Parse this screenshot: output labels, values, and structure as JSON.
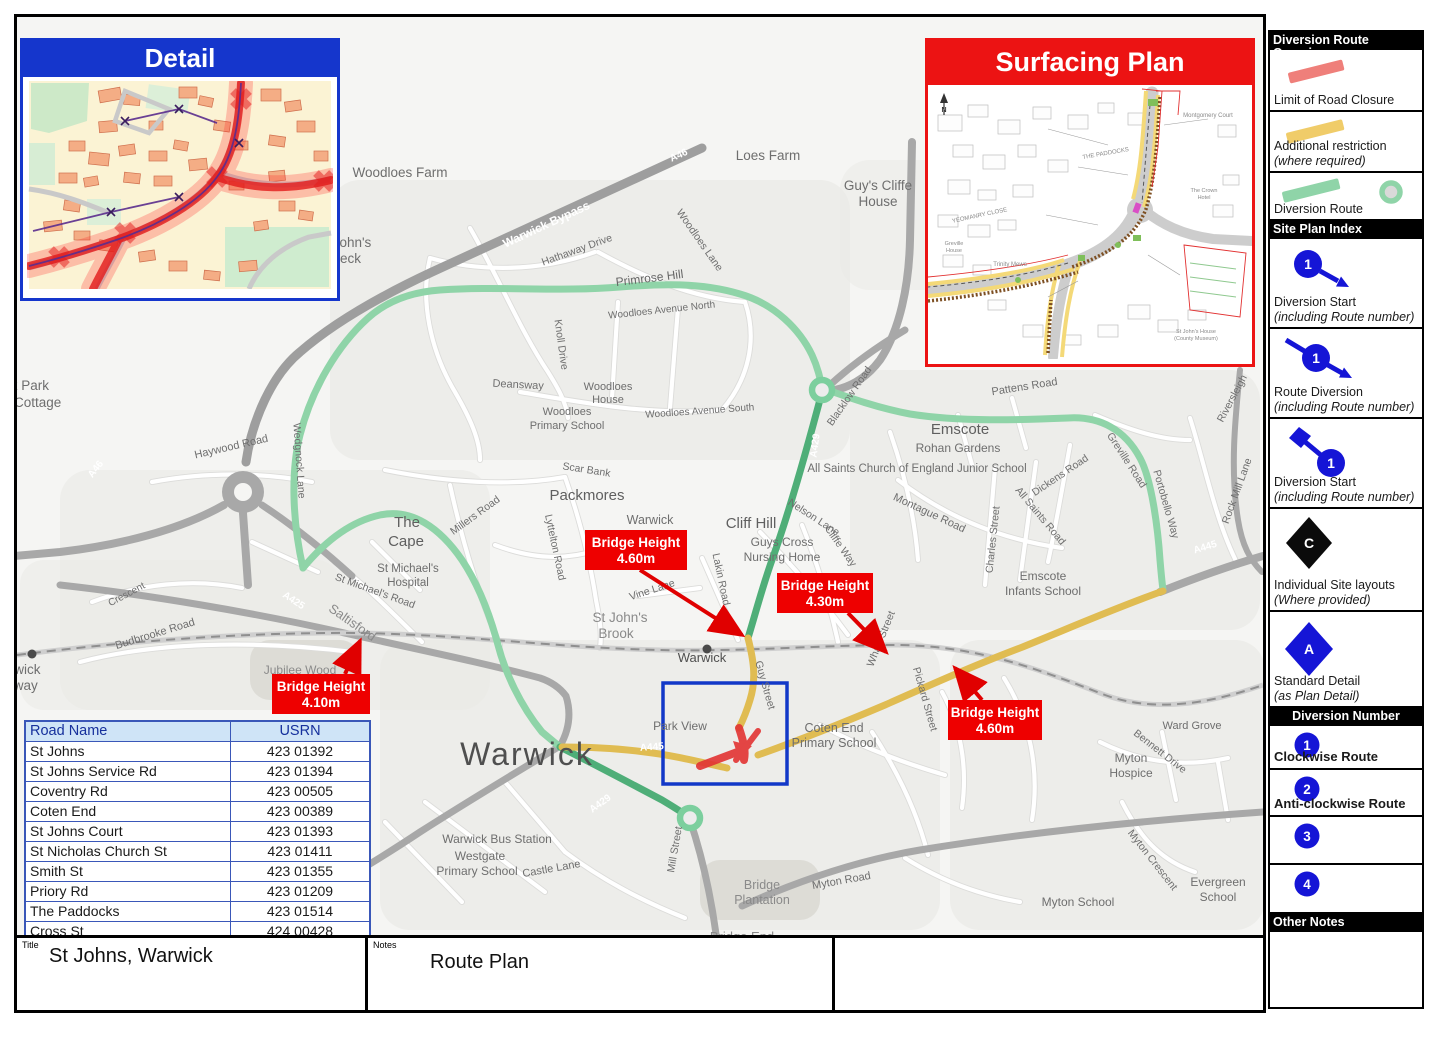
{
  "detail_inset": {
    "title": "Detail"
  },
  "surfacing_inset": {
    "title": "Surfacing Plan",
    "labels": [
      {
        "t": "N",
        "x": 16,
        "y": 27,
        "s": 7,
        "w": "b",
        "c": "#333333"
      },
      {
        "t": "Montgomery Court",
        "x": 280,
        "y": 32,
        "s": 6
      },
      {
        "t": "THE PADDOCKS",
        "x": 178,
        "y": 70,
        "s": 6,
        "r": -10
      },
      {
        "t": "YEOMANRY CLOSE",
        "x": 52,
        "y": 132,
        "s": 6,
        "r": -12
      },
      {
        "t": "Greville",
        "x": 26,
        "y": 160,
        "s": 5.5
      },
      {
        "t": "House",
        "x": 26,
        "y": 167,
        "s": 5.5
      },
      {
        "t": "Trinity Mews",
        "x": 82,
        "y": 181,
        "s": 6
      },
      {
        "t": "The Crown",
        "x": 276,
        "y": 107,
        "s": 5.5
      },
      {
        "t": "Hotel",
        "x": 276,
        "y": 114,
        "s": 5.5
      },
      {
        "t": "St John's House",
        "x": 268,
        "y": 248,
        "s": 5.5
      },
      {
        "t": "(County Museum)",
        "x": 268,
        "y": 255,
        "s": 5.5
      }
    ]
  },
  "legend": {
    "sections": [
      {
        "header": "Diversion Route Overview",
        "align": "left",
        "items": [
          {
            "icon": "closure-line",
            "h": 62,
            "lines": [
              {
                "t": "Limit of Road Closure"
              }
            ]
          },
          {
            "icon": "restriction-line",
            "h": 61,
            "lines": [
              {
                "t": "Additional restriction"
              },
              {
                "t": "(where required)",
                "i": true
              }
            ]
          },
          {
            "icon": "diversion-line",
            "h": 48,
            "lines": [
              {
                "t": "Diversion Route"
              }
            ]
          }
        ]
      },
      {
        "header": "Site Plan Index",
        "align": "left",
        "items": [
          {
            "icon": "diversion-start",
            "badge": "1",
            "h": 90,
            "lines": [
              {
                "t": "Diversion Start"
              },
              {
                "t": "(including Route number)",
                "i": true
              }
            ]
          },
          {
            "icon": "route-diversion",
            "badge": "1",
            "h": 90,
            "lines": [
              {
                "t": "Route Diversion"
              },
              {
                "t": "(including Route number)",
                "i": true
              }
            ]
          },
          {
            "icon": "diversion-start-flag",
            "badge": "1",
            "h": 90,
            "lines": [
              {
                "t": "Diversion Start"
              },
              {
                "t": "(including Route number)",
                "i": true
              }
            ]
          },
          {
            "icon": "site-layout-diamond",
            "badge": "C",
            "h": 103,
            "lines": [
              {
                "t": "Individual Site layouts"
              },
              {
                "t": "(Where provided)",
                "i": true
              }
            ]
          },
          {
            "icon": "standard-detail-diamond",
            "badge": "A",
            "h": 96,
            "lines": [
              {
                "t": "Standard Detail"
              },
              {
                "t": "(as Plan Detail)",
                "i": true
              }
            ]
          }
        ]
      },
      {
        "header": "Diversion Number",
        "align": "center",
        "items": [
          {
            "icon": "num",
            "badge": "1",
            "h": 44,
            "lines": [
              {
                "t": "Clockwise Route",
                "b": true
              }
            ]
          },
          {
            "icon": "num",
            "badge": "2",
            "h": 47,
            "lines": [
              {
                "t": "Anti-clockwise Route",
                "b": true
              }
            ]
          },
          {
            "icon": "num",
            "badge": "3",
            "h": 48,
            "lines": []
          },
          {
            "icon": "num",
            "badge": "4",
            "h": 49,
            "lines": []
          }
        ]
      },
      {
        "header": "Other Notes",
        "align": "left",
        "items": [
          {
            "icon": "none",
            "h": 75,
            "lines": []
          }
        ]
      }
    ]
  },
  "usrn_table": {
    "headers": [
      "Road Name",
      "USRN"
    ],
    "rows": [
      [
        "St Johns",
        "423 01392"
      ],
      [
        "St Johns Service Rd",
        "423 01394"
      ],
      [
        "Coventry Rd",
        "423 00505"
      ],
      [
        "Coten End",
        "423 00389"
      ],
      [
        "St Johns Court",
        "423 01393"
      ],
      [
        "St Nicholas Church St",
        "423 01411"
      ],
      [
        "Smith St",
        "423 01355"
      ],
      [
        "Priory Rd",
        "423 01209"
      ],
      [
        "The Paddocks",
        "423 01514"
      ],
      [
        "Cross St",
        "424 00428"
      ]
    ]
  },
  "title_block": {
    "title_label": "Title",
    "title": "St Johns, Warwick",
    "notes_label": "Notes",
    "notes": "Route Plan",
    "drawn_by_label": "Drawn By",
    "drawn_by": "Traffix",
    "date_label": "Date",
    "date": "10-Mar-26",
    "issue_label": "Issue",
    "issue": "1",
    "drw_label": "Drw No.",
    "drw_no": "SJ100326"
  },
  "logo": {
    "line1": "WARWICKSHIRE",
    "line2": "HIGHWAYS",
    "partner": "Balfour Beatty"
  },
  "colors": {
    "diversion_green": "#8fd4a8",
    "diversion_dark_green": "#4fae78",
    "restriction_yellow": "#e0bc52",
    "closure_red": "#e23333",
    "callout_red": "#ee0000",
    "legend_blue": "#1515d6",
    "detail_header_blue": "#1536cc",
    "surfacing_header_red": "#ec1313",
    "table_header_bg": "#cfe4f7",
    "table_border_blue": "#3a57b8",
    "logo_green": "#2e7d4f"
  },
  "map": {
    "labels": [
      {
        "t": "Woodloes Farm",
        "x": 400,
        "y": 177,
        "s": 13.5
      },
      {
        "t": "Loes Farm",
        "x": 768,
        "y": 160,
        "s": 13.5
      },
      {
        "t": "Guy's Cliffe",
        "x": 878,
        "y": 190,
        "s": 13.5
      },
      {
        "t": "House",
        "x": 878,
        "y": 206,
        "s": 13.5
      },
      {
        "t": "John's",
        "x": 352,
        "y": 247,
        "s": 13.5
      },
      {
        "t": "Beck",
        "x": 346,
        "y": 263,
        "s": 13.5
      },
      {
        "t": "Warwick Bypass",
        "x": 548,
        "y": 228,
        "s": 12,
        "r": -25,
        "c": "#ffffff",
        "w": "b"
      },
      {
        "t": "Hathaway Drive",
        "x": 578,
        "y": 253,
        "s": 10.5,
        "r": -20
      },
      {
        "t": "Primrose Hill",
        "x": 650,
        "y": 282,
        "s": 12,
        "r": -7,
        "c": "#666666"
      },
      {
        "t": "Woodloes Avenue North",
        "x": 662,
        "y": 313,
        "s": 10,
        "r": -6
      },
      {
        "t": "Knoll Drive",
        "x": 558,
        "y": 345,
        "s": 10.5,
        "r": 82
      },
      {
        "t": "Deansway",
        "x": 518,
        "y": 388,
        "s": 11,
        "r": 3
      },
      {
        "t": "Woodloes",
        "x": 608,
        "y": 390,
        "s": 11
      },
      {
        "t": "House",
        "x": 608,
        "y": 403,
        "s": 11
      },
      {
        "t": "Woodloes",
        "x": 567,
        "y": 415,
        "s": 11
      },
      {
        "t": "Primary School",
        "x": 567,
        "y": 429,
        "s": 11
      },
      {
        "t": "Woodloes Avenue South",
        "x": 700,
        "y": 414,
        "s": 10,
        "r": -4
      },
      {
        "t": "Woodloes Lane",
        "x": 697,
        "y": 242,
        "s": 10.5,
        "r": 55
      },
      {
        "t": "Scar Bank",
        "x": 586,
        "y": 473,
        "s": 10.5,
        "r": 9
      },
      {
        "t": "Packmores",
        "x": 587,
        "y": 500,
        "s": 15,
        "c": "#5f5f5f"
      },
      {
        "t": "The",
        "x": 407,
        "y": 527,
        "s": 15,
        "c": "#5f5f5f"
      },
      {
        "t": "Cape",
        "x": 406,
        "y": 546,
        "s": 15,
        "c": "#5f5f5f"
      },
      {
        "t": "Millers Road",
        "x": 477,
        "y": 518,
        "s": 10.5,
        "r": -36
      },
      {
        "t": "Lyttelton Road",
        "x": 552,
        "y": 548,
        "s": 10.5,
        "r": 78
      },
      {
        "t": "St Michael's",
        "x": 408,
        "y": 572,
        "s": 11.5
      },
      {
        "t": "Hospital",
        "x": 408,
        "y": 586,
        "s": 11.5
      },
      {
        "t": "St Michael's Road",
        "x": 374,
        "y": 594,
        "s": 10.5,
        "r": 20
      },
      {
        "t": "Saltisford",
        "x": 350,
        "y": 626,
        "s": 13,
        "r": 35,
        "c": "#8a8a8a"
      },
      {
        "t": "A425",
        "x": 292,
        "y": 603,
        "s": 10,
        "r": 33,
        "c": "#ffffff",
        "w": "b"
      },
      {
        "t": "Budbrooke Road",
        "x": 156,
        "y": 637,
        "s": 11,
        "r": -17
      },
      {
        "t": "Crescent",
        "x": 128,
        "y": 597,
        "s": 10,
        "r": -28
      },
      {
        "t": "Jubilee Wood",
        "x": 300,
        "y": 674,
        "s": 12,
        "c": "#8a8a8a"
      },
      {
        "t": "Warwick",
        "x": -10,
        "y": 674,
        "s": 13.5,
        "a": "s"
      },
      {
        "t": "Parkway",
        "x": -14,
        "y": 690,
        "s": 13.5,
        "a": "s"
      },
      {
        "t": "Wedgnock Park",
        "x": -46,
        "y": 390,
        "s": 13.5,
        "a": "s"
      },
      {
        "t": "Cottage",
        "x": 14,
        "y": 407,
        "s": 13.5,
        "a": "s"
      },
      {
        "t": "Haywood Road",
        "x": 232,
        "y": 450,
        "s": 11,
        "r": -13
      },
      {
        "t": "Wedgnock Lane",
        "x": 296,
        "y": 461,
        "s": 10.5,
        "r": 86
      },
      {
        "t": "A46",
        "x": 98,
        "y": 471,
        "s": 10,
        "r": -52,
        "c": "#ffffff",
        "w": "b"
      },
      {
        "t": "A46",
        "x": 680,
        "y": 158,
        "s": 10,
        "r": -25,
        "c": "#ffffff",
        "w": "b"
      },
      {
        "t": "Emscote",
        "x": 960,
        "y": 434,
        "s": 15,
        "c": "#5f5f5f"
      },
      {
        "t": "Rohan Gardens",
        "x": 958,
        "y": 452,
        "s": 12
      },
      {
        "t": "All Saints Church of England Junior School",
        "x": 917,
        "y": 472,
        "s": 11.5
      },
      {
        "t": "Pattens Road",
        "x": 1025,
        "y": 390,
        "s": 11,
        "r": -9
      },
      {
        "t": "Montague Road",
        "x": 928,
        "y": 516,
        "s": 11,
        "r": 25
      },
      {
        "t": "Nelson Lane",
        "x": 812,
        "y": 520,
        "s": 10.5,
        "r": 33
      },
      {
        "t": "Cliffe Way",
        "x": 838,
        "y": 548,
        "s": 10.5,
        "r": 55
      },
      {
        "t": "Charles Street",
        "x": 996,
        "y": 540,
        "s": 10.5,
        "r": -84
      },
      {
        "t": "All Saints Road",
        "x": 1038,
        "y": 518,
        "s": 10.5,
        "r": 50
      },
      {
        "t": "Dickens Road",
        "x": 1062,
        "y": 478,
        "s": 10.5,
        "r": -34
      },
      {
        "t": "Greville Road",
        "x": 1124,
        "y": 462,
        "s": 10.5,
        "r": 57
      },
      {
        "t": "Portobello Way",
        "x": 1163,
        "y": 505,
        "s": 10.5,
        "r": 74
      },
      {
        "t": "Rock Mill Lane",
        "x": 1240,
        "y": 492,
        "s": 10.5,
        "r": -70
      },
      {
        "t": "Riversleigh",
        "x": 1235,
        "y": 400,
        "s": 10.5,
        "r": -62
      },
      {
        "t": "Emscote",
        "x": 1043,
        "y": 580,
        "s": 12
      },
      {
        "t": "Infants School",
        "x": 1043,
        "y": 595,
        "s": 12
      },
      {
        "t": "A445",
        "x": 1206,
        "y": 550,
        "s": 10,
        "r": -17,
        "c": "#ffffff",
        "w": "b"
      },
      {
        "t": "St John's",
        "x": 620,
        "y": 622,
        "s": 13.5,
        "c": "#8a8a8a"
      },
      {
        "t": "Brook",
        "x": 616,
        "y": 638,
        "s": 13.5,
        "c": "#8a8a8a"
      },
      {
        "t": "Vine Lane",
        "x": 653,
        "y": 593,
        "s": 10.5,
        "r": -18
      },
      {
        "t": "Lakin Road",
        "x": 718,
        "y": 580,
        "s": 10.5,
        "r": 78
      },
      {
        "t": "Warwick",
        "x": 702,
        "y": 662,
        "s": 13,
        "c": "#4f4f4f"
      },
      {
        "t": "Cliff Hill",
        "x": 751,
        "y": 528,
        "s": 15,
        "c": "#5f5f5f"
      },
      {
        "t": "Guys Cross",
        "x": 782,
        "y": 546,
        "s": 12
      },
      {
        "t": "Nursing Home",
        "x": 782,
        "y": 561,
        "s": 12
      },
      {
        "t": "Wharf Street",
        "x": 884,
        "y": 640,
        "s": 10.5,
        "r": -68
      },
      {
        "t": "Park View",
        "x": 680,
        "y": 730,
        "s": 12
      },
      {
        "t": "Guy Street",
        "x": 762,
        "y": 686,
        "s": 10.5,
        "r": 74
      },
      {
        "t": "Coten End",
        "x": 834,
        "y": 732,
        "s": 12.5
      },
      {
        "t": "Primary School",
        "x": 834,
        "y": 747,
        "s": 12.5
      },
      {
        "t": "Pickard Street",
        "x": 922,
        "y": 700,
        "s": 10.5,
        "r": 74
      },
      {
        "t": "A445",
        "x": 652,
        "y": 750,
        "s": 10,
        "r": -4,
        "c": "#ffffff",
        "w": "b"
      },
      {
        "t": "A429",
        "x": 602,
        "y": 806,
        "s": 10,
        "r": -36,
        "c": "#ffffff",
        "w": "b"
      },
      {
        "t": "A429",
        "x": 818,
        "y": 446,
        "s": 10,
        "r": -82,
        "c": "#ffffff",
        "w": "b"
      },
      {
        "t": "Blacklow Road",
        "x": 852,
        "y": 398,
        "s": 10.5,
        "r": -55
      },
      {
        "t": "Warwick",
        "x": 527,
        "y": 765,
        "s": 32,
        "c": "#4f4f4f",
        "sp": 2
      },
      {
        "t": "Warwick",
        "x": 650,
        "y": 524,
        "s": 12.5
      },
      {
        "t": "Warwick Bus Station",
        "x": 497,
        "y": 843,
        "s": 12
      },
      {
        "t": "Westgate",
        "x": 480,
        "y": 860,
        "s": 12
      },
      {
        "t": "Primary School",
        "x": 477,
        "y": 875,
        "s": 12
      },
      {
        "t": "Castle Lane",
        "x": 552,
        "y": 872,
        "s": 11,
        "r": -10
      },
      {
        "t": "Mill Street",
        "x": 678,
        "y": 850,
        "s": 10.5,
        "r": -80
      },
      {
        "t": "Bridge",
        "x": 762,
        "y": 889,
        "s": 12.5,
        "c": "#8a8a8a"
      },
      {
        "t": "Plantation",
        "x": 762,
        "y": 904,
        "s": 12.5,
        "c": "#8a8a8a"
      },
      {
        "t": "Bridge End",
        "x": 742,
        "y": 941,
        "s": 13,
        "c": "#8a8a8a"
      },
      {
        "t": "Myton Road",
        "x": 842,
        "y": 884,
        "s": 11,
        "r": -10
      },
      {
        "t": "Myton School",
        "x": 1078,
        "y": 906,
        "s": 12
      },
      {
        "t": "Myton",
        "x": 1131,
        "y": 762,
        "s": 12
      },
      {
        "t": "Hospice",
        "x": 1131,
        "y": 777,
        "s": 12
      },
      {
        "t": "Ward Grove",
        "x": 1192,
        "y": 729,
        "s": 11
      },
      {
        "t": "Bennett Drive",
        "x": 1158,
        "y": 754,
        "s": 10.5,
        "r": 38
      },
      {
        "t": "Myton Crescent",
        "x": 1150,
        "y": 862,
        "s": 10.5,
        "r": 52
      },
      {
        "t": "Evergreen",
        "x": 1218,
        "y": 886,
        "s": 12
      },
      {
        "t": "School",
        "x": 1218,
        "y": 901,
        "s": 12
      }
    ],
    "callouts": [
      {
        "line1": "Bridge Height",
        "line2": "4.60m",
        "x": 585,
        "y": 530,
        "w": 102,
        "h": 40,
        "ax1": 640,
        "ay1": 570,
        "ax2": 742,
        "ay2": 635
      },
      {
        "line1": "Bridge Height",
        "line2": "4.30m",
        "x": 777,
        "y": 573,
        "w": 96,
        "h": 40,
        "ax1": 848,
        "ay1": 613,
        "ax2": 886,
        "ay2": 652
      },
      {
        "line1": "Bridge Height",
        "line2": "4.10m",
        "x": 272,
        "y": 674,
        "w": 98,
        "h": 40,
        "ax1": 345,
        "ay1": 674,
        "ax2": 360,
        "ay2": 641
      },
      {
        "line1": "Bridge Height",
        "line2": "4.60m",
        "x": 948,
        "y": 700,
        "w": 94,
        "h": 40,
        "ax1": 982,
        "ay1": 700,
        "ax2": 955,
        "ay2": 668
      }
    ]
  }
}
